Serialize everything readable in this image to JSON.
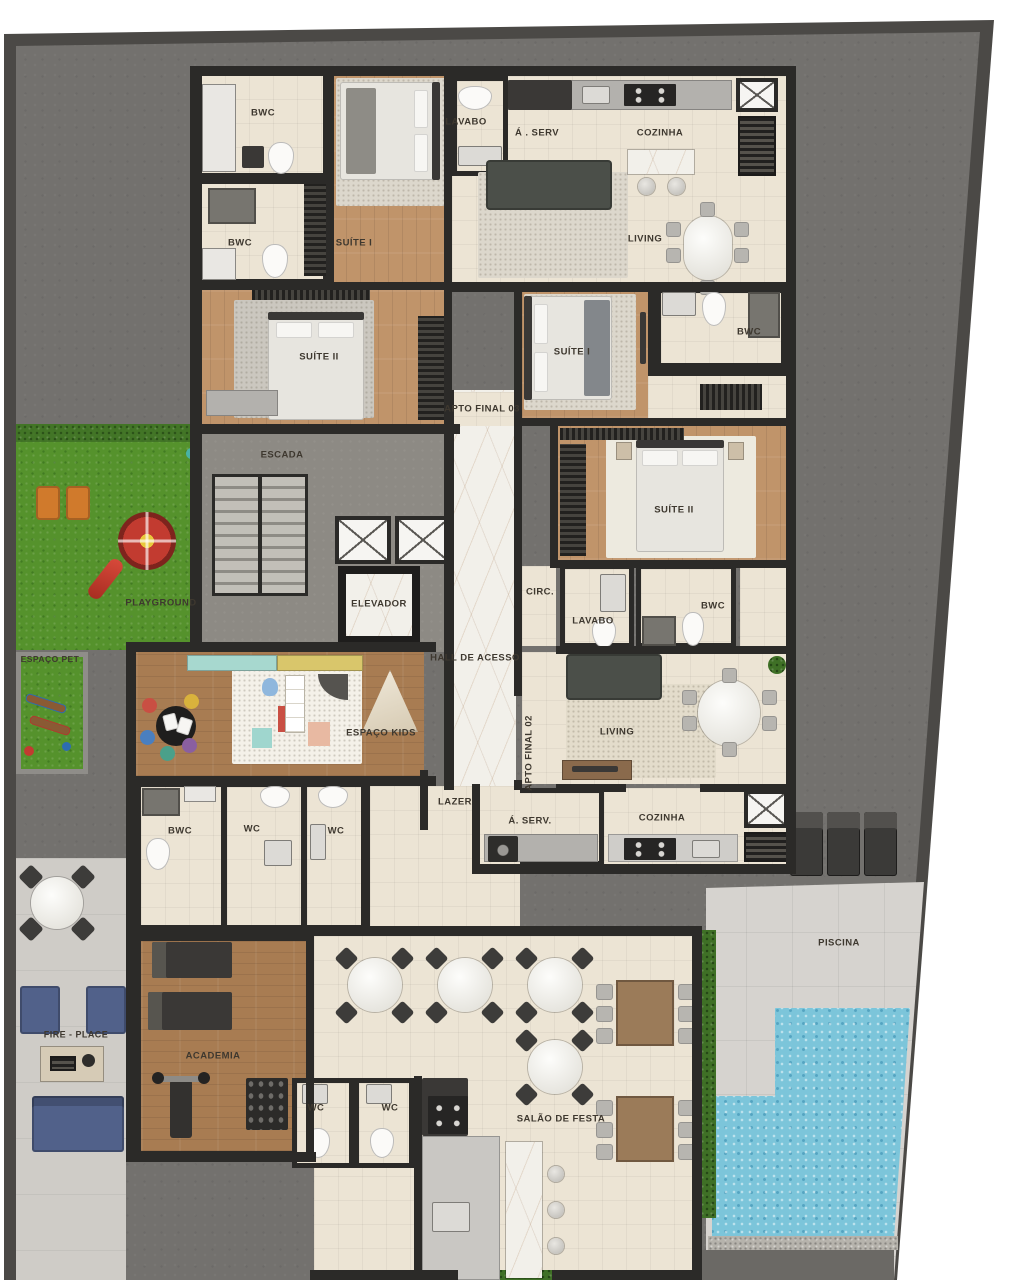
{
  "labels": {
    "bwc_a1": "BWC",
    "lavabo_a": "LAVABO",
    "aserv_a": "Á . SERV",
    "cozinha_a": "COZINHA",
    "living_a": "LIVING",
    "bwc_a2": "BWC",
    "suite1_a": "SUÍTE I",
    "suite2_a": "SUÍTE II",
    "suite1_b": "SUÍTE I",
    "bwc_b1": "BWC",
    "apto_final_03": "APTO FINAL 03",
    "escada": "ESCADA",
    "suite2_b": "SUÍTE II",
    "elevador": "ELEVADOR",
    "circ": "CIRC.",
    "lavabo_b": "LAVABO",
    "bwc_b2": "BWC",
    "hall": "HALL DE ACESSO",
    "playground": "PLAYGROUND",
    "espaco_pet": "ESPAÇO PET",
    "espaco_kids": "ESPAÇO KIDS",
    "living_b": "LIVING",
    "apto_final_02": "APTO FINAL 02",
    "lazer": "LAZER",
    "aserv_b": "Á. SERV.",
    "cozinha_b": "COZINHA",
    "bwc_c": "BWC",
    "wc_c1": "WC",
    "wc_c2": "WC",
    "piscina": "PISCINA",
    "fire_place": "FIRE - PLACE",
    "academia": "ACADEMIA",
    "wc_s1": "WC",
    "wc_s2": "WC",
    "salao": "SALÃO DE FESTA"
  },
  "palette": {
    "wall": "#2b2a28",
    "tile_floor": "#ece4d4",
    "wood_floor": "#c0946a",
    "wood_floor_dark": "#a87c52",
    "marble_floor": "#f2f0ea",
    "concrete": "#73716e",
    "concrete_core": "#8d8a84",
    "deck": "#d6d3cf",
    "patio": "#cfccc7",
    "grass": "#55922c",
    "pool_water": "#7cc5da",
    "hedge": "#3f7026",
    "slide_red": "#c23b30",
    "bench_orange": "#d07a2c",
    "sofa_blue": "#51618a",
    "label_text": "#3e382f"
  }
}
